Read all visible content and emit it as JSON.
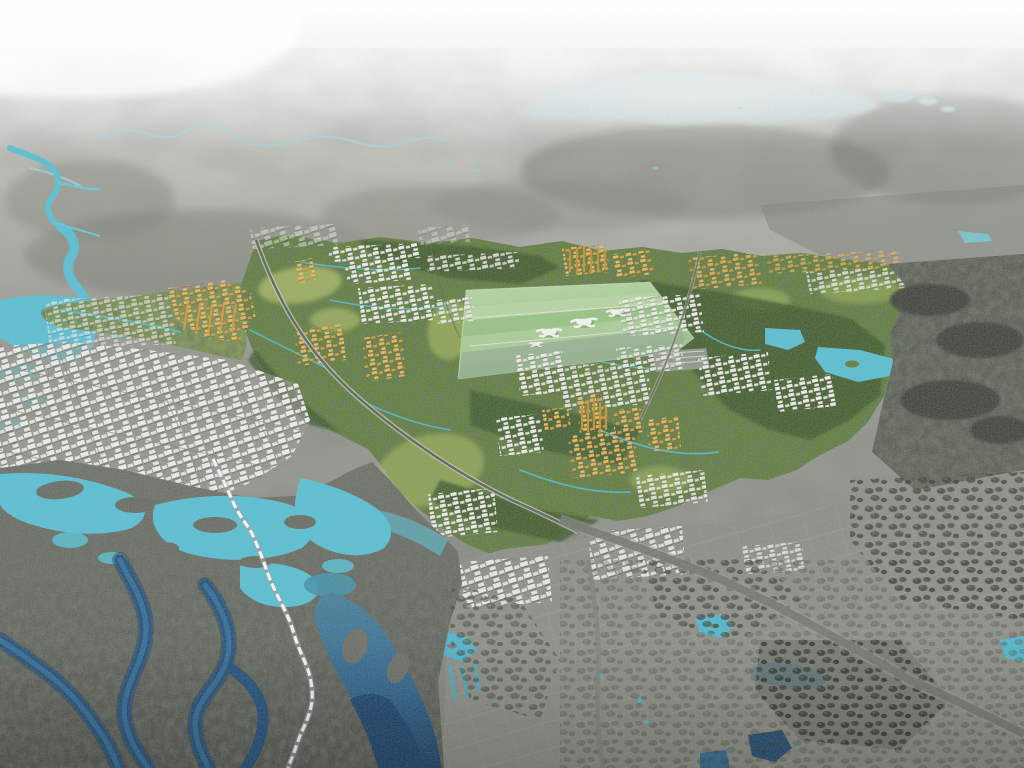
{
  "scene": {
    "description": "Bird's-eye aerial rendering of a new-town masterplan: a green development area with an airport, orange and white building clusters sits within grayscale aerial terrain, bordered by turquoise rivers, mangrove wetlands with deep blue channels, a pale distant lake and gray existing city fabric.",
    "palette": {
      "sky_top": "#f7f8f7",
      "sky_haze": "#e8eae7",
      "terrain_far": "#c9cac5",
      "terrain_light": "#b0b1ab",
      "terrain_mid": "#94958f",
      "terrain_base": "#898a84",
      "terrain_shadow": "#74756d",
      "forest_gray": "#6e7067",
      "lake_pale_center": "#e3e9e7",
      "lake_pale_edge": "#bed1d5",
      "pond_pale": "#79c6d2",
      "water_cyan": "#55c3d9",
      "stream_cyan": "#4cc0d6",
      "water_teal": "#3f92ad",
      "water_steel": "#44809c",
      "water_navy": "#1c4e7d",
      "water_navy_deep": "#16406b",
      "plan_green": "#5f7d37",
      "plan_green_soft": "#7a9447",
      "forest_dark": "#3c572b",
      "forest_charcoal": "#575c52",
      "open_green": "#b5c46b",
      "field_light": "#b9dca6",
      "field_mid": "#94c47f",
      "apron_gray": "#97a99b",
      "building_white": "#f4f4f0",
      "building_white_dim": "#e9eae3",
      "building_orange": "#ecb558",
      "building_orange_dark": "#d89a39",
      "city_gray": "#8c8e87",
      "wetland_base": "#6d7168",
      "wetland_dark": "#51554e",
      "tree_dark": "#2f372c",
      "road_white": "#ffffff",
      "road_gray": "#72746d",
      "road_light_edge": "#c9cec0",
      "terminal_white": "#fdfdfb"
    },
    "features": [
      {
        "name": "hazy-horizon",
        "color": "#f7f8f7"
      },
      {
        "name": "pale-distant-lake",
        "color": "#bed1d5"
      },
      {
        "name": "meandering-distant-river",
        "color": "#a5d6da"
      },
      {
        "name": "turquoise-river-network",
        "color": "#55c3d9"
      },
      {
        "name": "green-masterplan-area",
        "color": "#5f7d37"
      },
      {
        "name": "airport-site-with-terminals",
        "color": "#b9dca6"
      },
      {
        "name": "orange-development-clusters",
        "color": "#ecb558"
      },
      {
        "name": "white-building-districts",
        "color": "#f4f4f0"
      },
      {
        "name": "existing-city-white-blocks",
        "color": "#f4f4f0"
      },
      {
        "name": "mangrove-wetland",
        "color": "#51554e"
      },
      {
        "name": "deep-blue-channels",
        "color": "#1c4e7d"
      },
      {
        "name": "white-causeway-road",
        "color": "#ffffff"
      },
      {
        "name": "gray-highway",
        "color": "#72746d"
      },
      {
        "name": "southern-gray-city",
        "color": "#8c8e87"
      },
      {
        "name": "eastern-forest",
        "color": "#575c52"
      }
    ]
  }
}
